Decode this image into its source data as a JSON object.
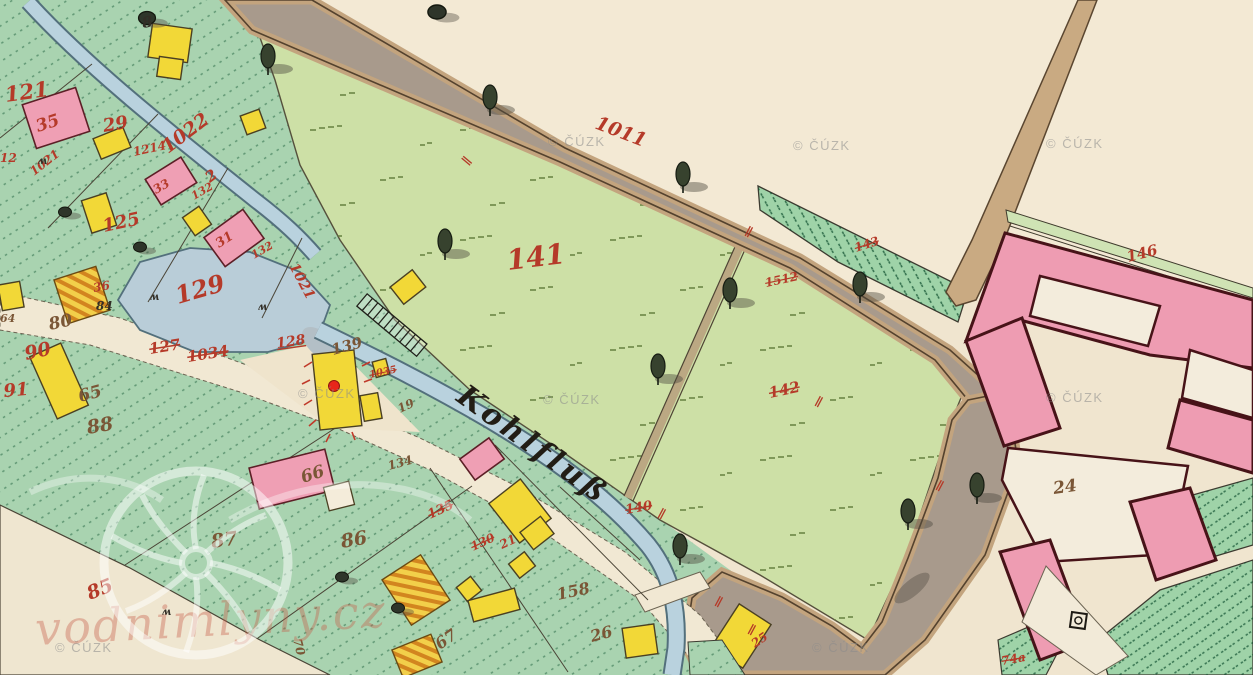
{
  "map": {
    "stream_label": {
      "text": "Kohlfluß"
    },
    "marker": {
      "color": "#e8261a",
      "x": 334,
      "y": 386
    },
    "palette": {
      "paper": "#f0e5cf",
      "village_green": "#a9d3b0",
      "meadow_green": "#cde0a6",
      "garden_green": "#9fd3a8",
      "road_gray": "#a89a8c",
      "road_tan": "#c3a47e",
      "stream_blue": "#b9d2de",
      "building_pink": "#ef9fb4",
      "building_yellow": "#f2d837",
      "red_ink": "#b53a29"
    },
    "labels": [
      {
        "t": "121",
        "x": 6,
        "y": 102,
        "s": 21,
        "r": -8,
        "c": "red"
      },
      {
        "t": "35",
        "x": 38,
        "y": 132,
        "s": 17,
        "r": -18,
        "c": "red"
      },
      {
        "t": "29",
        "x": 104,
        "y": 132,
        "s": 18,
        "r": -10,
        "c": "red"
      },
      {
        "t": "1022",
        "x": 168,
        "y": 154,
        "s": 19,
        "r": -37,
        "c": "red"
      },
      {
        "t": "2",
        "x": 210,
        "y": 183,
        "s": 15,
        "r": -37,
        "c": "red"
      },
      {
        "t": "1214",
        "x": 134,
        "y": 156,
        "s": 12,
        "r": -12,
        "c": "red"
      },
      {
        "t": "12",
        "x": 0,
        "y": 162,
        "s": 12,
        "r": 0,
        "c": "red"
      },
      {
        "t": "1021",
        "x": 34,
        "y": 176,
        "s": 12,
        "r": -38,
        "c": "red"
      },
      {
        "t": "33",
        "x": 156,
        "y": 194,
        "s": 12,
        "r": -30,
        "c": "red"
      },
      {
        "t": "132",
        "x": 194,
        "y": 200,
        "s": 11,
        "r": -30,
        "c": "red"
      },
      {
        "t": "125",
        "x": 104,
        "y": 232,
        "s": 18,
        "r": -12,
        "c": "red"
      },
      {
        "t": "31",
        "x": 219,
        "y": 248,
        "s": 13,
        "r": -33,
        "c": "red"
      },
      {
        "t": "132",
        "x": 254,
        "y": 259,
        "s": 11,
        "r": -30,
        "c": "red"
      },
      {
        "t": "129",
        "x": 178,
        "y": 304,
        "s": 24,
        "r": -16,
        "c": "red"
      },
      {
        "t": "1021",
        "x": 289,
        "y": 266,
        "s": 14,
        "r": 62,
        "c": "red"
      },
      {
        "t": "36",
        "x": 94,
        "y": 292,
        "s": 12,
        "r": -10,
        "c": "red"
      },
      {
        "t": "128",
        "x": 277,
        "y": 348,
        "s": 14,
        "r": -8,
        "c": "red",
        "ul": true
      },
      {
        "t": "127",
        "x": 150,
        "y": 354,
        "s": 15,
        "r": -9,
        "c": "red",
        "st": true
      },
      {
        "t": "1034",
        "x": 188,
        "y": 362,
        "s": 15,
        "r": -9,
        "c": "red",
        "st": true
      },
      {
        "t": "90",
        "x": 26,
        "y": 360,
        "s": 19,
        "r": -12,
        "c": "red"
      },
      {
        "t": "91",
        "x": 4,
        "y": 397,
        "s": 18,
        "r": -5,
        "c": "red"
      },
      {
        "t": "1035",
        "x": 370,
        "y": 378,
        "s": 10,
        "r": -12,
        "c": "red",
        "st": true
      },
      {
        "t": "141",
        "x": 508,
        "y": 270,
        "s": 28,
        "r": -7,
        "c": "red"
      },
      {
        "t": "1011",
        "x": 594,
        "y": 128,
        "s": 19,
        "r": 21,
        "c": "red"
      },
      {
        "t": "1512",
        "x": 766,
        "y": 287,
        "s": 12,
        "r": -12,
        "c": "red",
        "st": true
      },
      {
        "t": "143",
        "x": 856,
        "y": 252,
        "s": 12,
        "r": -18,
        "c": "red",
        "st": true
      },
      {
        "t": "142",
        "x": 770,
        "y": 398,
        "s": 15,
        "r": -12,
        "c": "red",
        "st": true
      },
      {
        "t": "146",
        "x": 1128,
        "y": 262,
        "s": 15,
        "r": -14,
        "c": "red"
      },
      {
        "t": "135",
        "x": 430,
        "y": 519,
        "s": 13,
        "r": -25,
        "c": "red",
        "st": true
      },
      {
        "t": "130",
        "x": 473,
        "y": 551,
        "s": 12,
        "r": -25,
        "c": "red",
        "st": true
      },
      {
        "t": "21",
        "x": 502,
        "y": 549,
        "s": 12,
        "r": -25,
        "c": "red"
      },
      {
        "t": "140",
        "x": 626,
        "y": 514,
        "s": 13,
        "r": -10,
        "c": "red",
        "st": true
      },
      {
        "t": "85",
        "x": 90,
        "y": 600,
        "s": 19,
        "r": -22,
        "c": "red"
      },
      {
        "t": "25",
        "x": 755,
        "y": 648,
        "s": 12,
        "r": -35,
        "c": "red"
      },
      {
        "t": "74a",
        "x": 1002,
        "y": 665,
        "s": 12,
        "r": -10,
        "c": "red",
        "st": true
      },
      {
        "t": "∥",
        "x": 744,
        "y": 234,
        "s": 12,
        "r": 28,
        "c": "red"
      },
      {
        "t": "∥",
        "x": 814,
        "y": 404,
        "s": 12,
        "r": 28,
        "c": "red"
      },
      {
        "t": "∥",
        "x": 657,
        "y": 516,
        "s": 12,
        "r": 28,
        "c": "red"
      },
      {
        "t": "∥",
        "x": 935,
        "y": 488,
        "s": 12,
        "r": 28,
        "c": "red"
      },
      {
        "t": "∥",
        "x": 747,
        "y": 632,
        "s": 12,
        "r": 28,
        "c": "red"
      },
      {
        "t": "∥",
        "x": 714,
        "y": 604,
        "s": 12,
        "r": 28,
        "c": "red"
      },
      {
        "t": "∥",
        "x": 468,
        "y": 166,
        "s": 12,
        "r": -50,
        "c": "red"
      },
      {
        "t": "8",
        "x": 143,
        "y": 28,
        "s": 15,
        "r": -10,
        "c": "black"
      },
      {
        "t": "84",
        "x": 96,
        "y": 310,
        "s": 12,
        "r": 0,
        "c": "black"
      },
      {
        "t": "80",
        "x": 50,
        "y": 330,
        "s": 17,
        "r": -12,
        "c": "brown"
      },
      {
        "t": "64",
        "x": 0,
        "y": 322,
        "s": 11,
        "r": 0,
        "c": "brown"
      },
      {
        "t": "65",
        "x": 80,
        "y": 402,
        "s": 17,
        "r": -15,
        "c": "brown"
      },
      {
        "t": "88",
        "x": 88,
        "y": 434,
        "s": 19,
        "r": -10,
        "c": "brown"
      },
      {
        "t": "87",
        "x": 212,
        "y": 548,
        "s": 19,
        "r": -8,
        "c": "brown"
      },
      {
        "t": "86",
        "x": 342,
        "y": 548,
        "s": 19,
        "r": -10,
        "c": "brown"
      },
      {
        "t": "66",
        "x": 303,
        "y": 483,
        "s": 17,
        "r": -18,
        "c": "brown"
      },
      {
        "t": "67",
        "x": 440,
        "y": 650,
        "s": 16,
        "r": -35,
        "c": "brown"
      },
      {
        "t": "26",
        "x": 592,
        "y": 642,
        "s": 16,
        "r": -15,
        "c": "brown"
      },
      {
        "t": "158",
        "x": 558,
        "y": 600,
        "s": 16,
        "r": -12,
        "c": "brown"
      },
      {
        "t": "139",
        "x": 333,
        "y": 355,
        "s": 15,
        "r": -15,
        "c": "brown"
      },
      {
        "t": "19",
        "x": 400,
        "y": 413,
        "s": 12,
        "r": -25,
        "c": "brown"
      },
      {
        "t": "134",
        "x": 389,
        "y": 470,
        "s": 12,
        "r": -15,
        "c": "brown"
      },
      {
        "t": "24",
        "x": 1054,
        "y": 494,
        "s": 17,
        "r": -8,
        "c": "brown"
      },
      {
        "t": "70",
        "x": 293,
        "y": 640,
        "s": 12,
        "r": 75,
        "c": "brown"
      },
      {
        "t": "ʍ",
        "x": 38,
        "y": 164,
        "s": 10,
        "r": 0,
        "c": "black"
      },
      {
        "t": "ʍ",
        "x": 150,
        "y": 300,
        "s": 10,
        "r": 0,
        "c": "black"
      },
      {
        "t": "ʍ",
        "x": 258,
        "y": 310,
        "s": 10,
        "r": 0,
        "c": "black"
      },
      {
        "t": "ʍ",
        "x": 162,
        "y": 615,
        "s": 10,
        "r": 0,
        "c": "black"
      }
    ],
    "watermarks": {
      "cuzk_text": "© ČÚZK",
      "cuzk_positions": [
        [
          548,
          146
        ],
        [
          793,
          150
        ],
        [
          1046,
          148
        ],
        [
          298,
          398
        ],
        [
          543,
          404
        ],
        [
          1046,
          402
        ],
        [
          55,
          652
        ],
        [
          812,
          652
        ]
      ],
      "site_text": "vodnimlyny.cz",
      "site_pos": {
        "x": 36,
        "y": 645
      }
    }
  }
}
